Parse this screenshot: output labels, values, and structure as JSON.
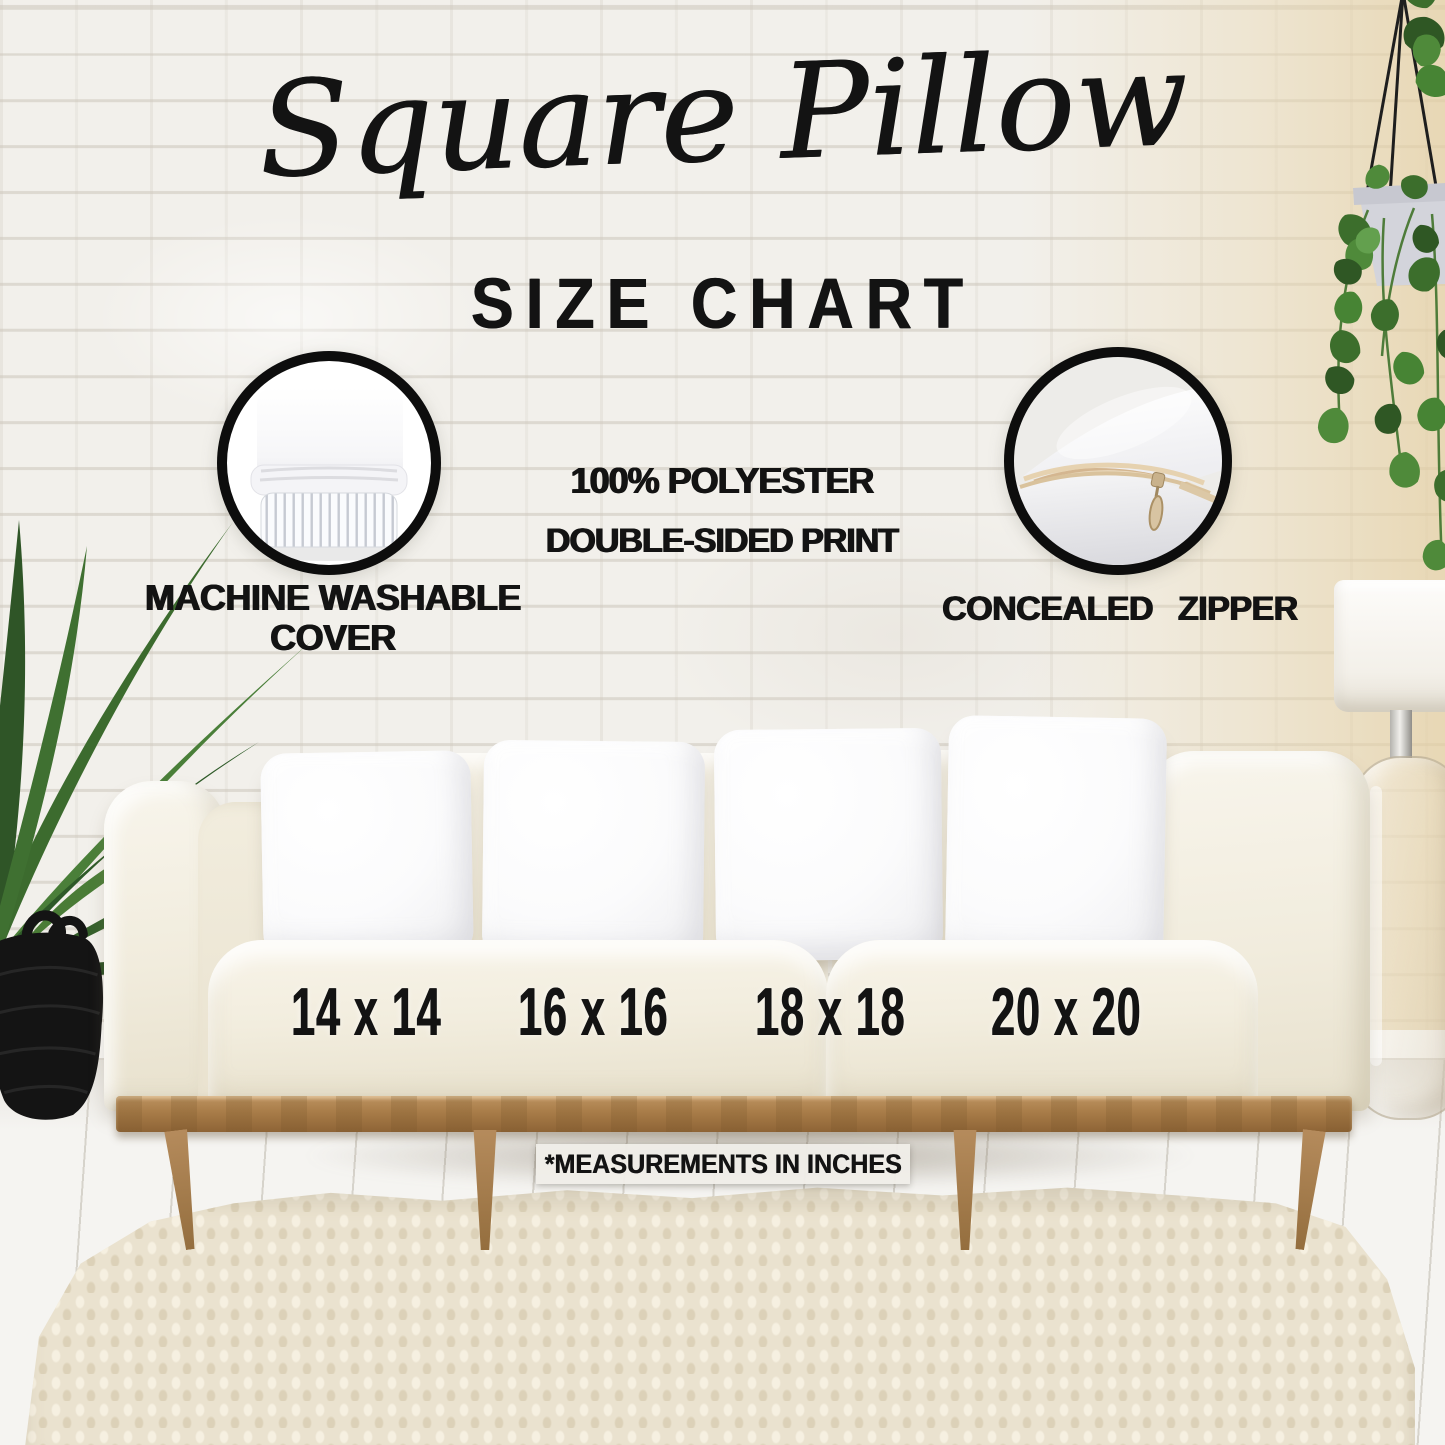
{
  "header": {
    "title_script": "Square Pillow",
    "title_sub": "SIZE CHART"
  },
  "features": {
    "washable": {
      "line1": "MACHINE WASHABLE",
      "line2": "COVER"
    },
    "material": {
      "line1": "100% POLYESTER",
      "line2": "DOUBLE-SIDED PRINT"
    },
    "zipper": {
      "label": "CONCEALED ZIPPER"
    }
  },
  "sizes": [
    "14 x 14",
    "16 x 16",
    "18 x 18",
    "20 x 20"
  ],
  "footnote": "*MEASUREMENTS IN INCHES",
  "icons": {
    "washable_badge": "pillow-with-striped-insert-photo",
    "zipper_badge": "pillow-corner-open-zipper-photo"
  },
  "colors": {
    "ink": "#131313",
    "wall": "#f2f0eb",
    "fabric": "#f4f0e4",
    "wood": "#ad8254",
    "pillow": "#fbfbfc",
    "rug": "#eae2cf",
    "floor": "#f5f4f1",
    "leaf": "#3e6b2f"
  }
}
